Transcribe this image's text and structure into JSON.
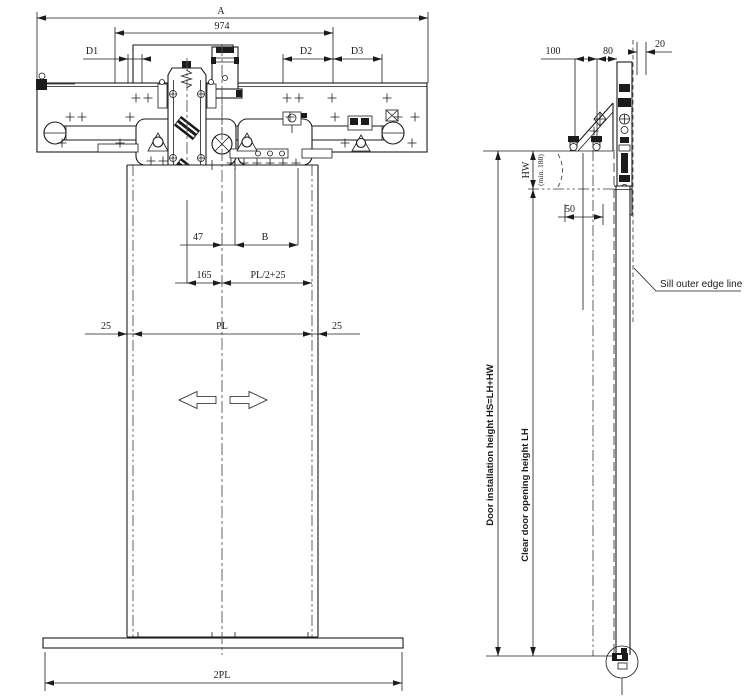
{
  "front": {
    "dim_a": "A",
    "dim_974": "974",
    "dim_d1": "D1",
    "dim_d2": "D2",
    "dim_d3": "D3",
    "dim_47": "47",
    "dim_b": "B",
    "dim_165": "165",
    "dim_pl2_25": "PL/2+25",
    "dim_25_left": "25",
    "dim_pl": "PL",
    "dim_25_right": "25",
    "dim_2pl": "2PL"
  },
  "side": {
    "dim_100": "100",
    "dim_80": "80",
    "dim_20": "20",
    "dim_50": "50",
    "dim_hw": "HW",
    "dim_hw_min": "(min. 180)",
    "label_install_height": "Door installation height  HS=LH+HW",
    "label_clear_height": "Clear door opening height  LH",
    "label_sill_edge": "Sill outer edge line"
  },
  "colors": {
    "line": "#1b1b1b",
    "background": "#ffffff"
  }
}
